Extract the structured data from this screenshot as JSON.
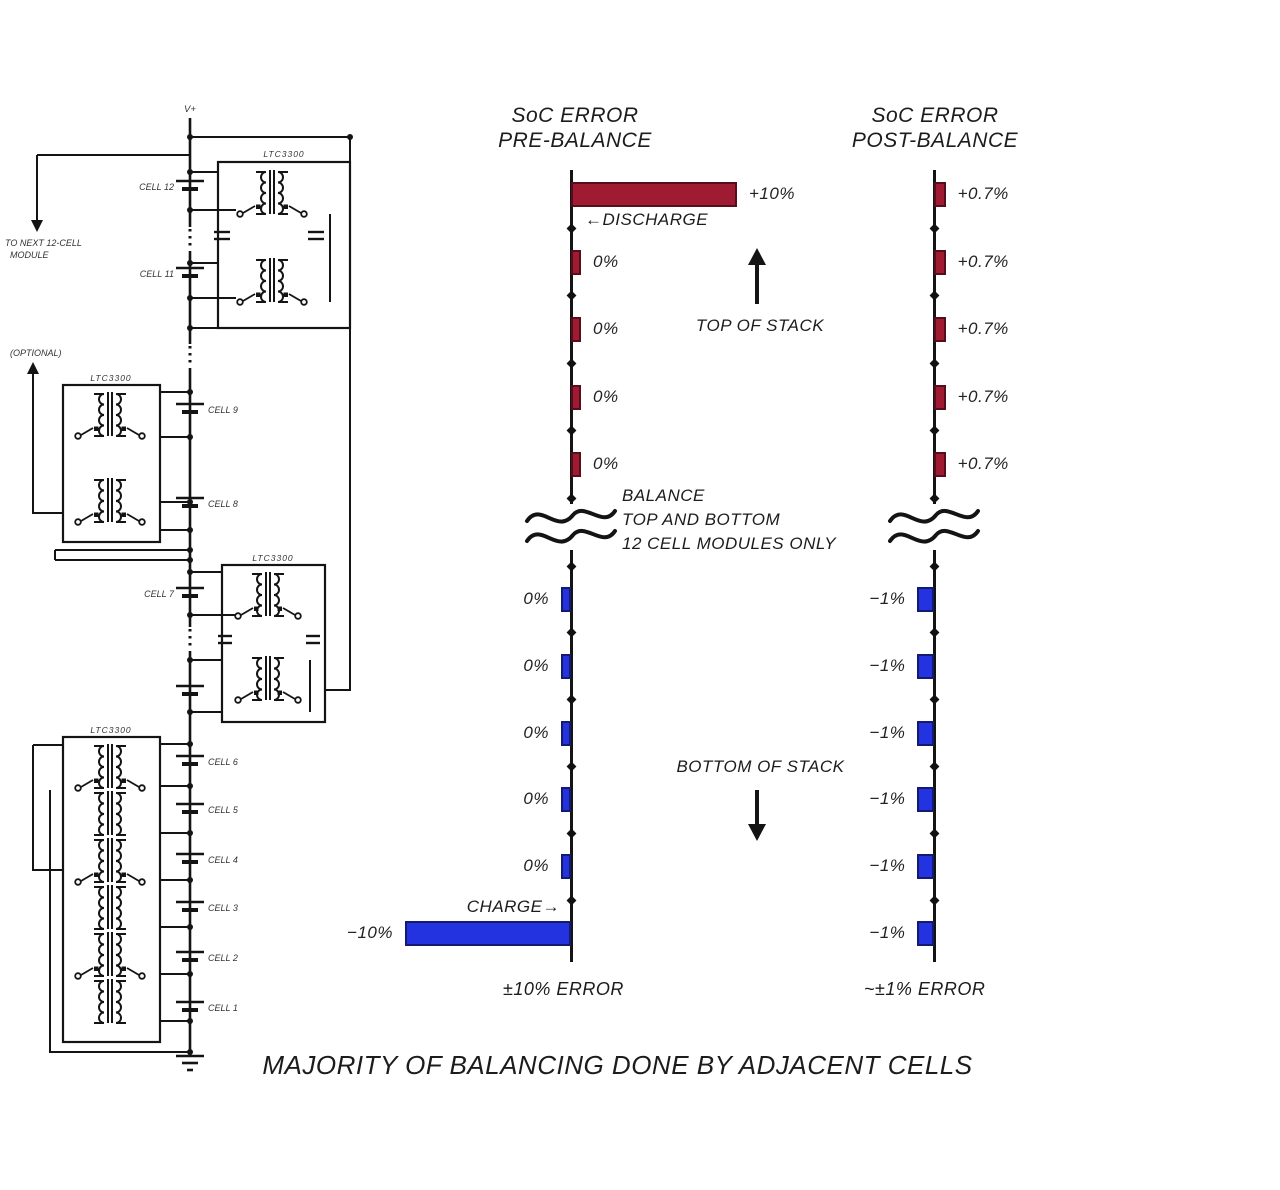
{
  "page": {
    "footer_title": "MAJORITY OF BALANCING DONE BY ADJACENT CELLS"
  },
  "colors": {
    "discharge_red": "#9e1b32",
    "discharge_red_border": "#560d1c",
    "charge_blue": "#2433e0",
    "charge_blue_border": "#141a6e",
    "line_black": "#141414"
  },
  "schematic": {
    "stack_top_label": "V+",
    "ground": "GND",
    "cells": [
      "CELL 12",
      "CELL 11",
      "CELL 9",
      "CELL 8",
      "CELL 7",
      "CELL 6",
      "CELL 5",
      "CELL 4",
      "CELL 3",
      "CELL 2",
      "CELL 1"
    ],
    "modules": [
      {
        "chip": "LTC3300"
      },
      {
        "chip": "LTC3300"
      },
      {
        "chip": "LTC3300"
      },
      {
        "chip": "LTC3300"
      }
    ],
    "annotation_top": {
      "line1": "TO NEXT 12-CELL",
      "line2": "MODULE"
    },
    "annotation_mid": "(OPTIONAL)"
  },
  "annotations": {
    "top_of_stack": "TOP OF STACK",
    "bottom_of_stack": "BOTTOM OF STACK",
    "balance_line1": "BALANCE",
    "balance_line2": "TOP AND BOTTOM",
    "balance_line3": "12 CELL MODULES ONLY"
  },
  "chart_data": [
    {
      "type": "bar",
      "orientation": "horizontal",
      "title1": "SoC ERROR",
      "title2": "PRE-BALANCE",
      "axis": "battery stack position (top to bottom)",
      "units": "% state-of-charge error",
      "top_bars": {
        "color_key": "discharge_red",
        "values": [
          10,
          0,
          0,
          0,
          0
        ],
        "labels": [
          "+10%",
          "0%",
          "0%",
          "0%",
          "0%"
        ]
      },
      "bottom_bars": {
        "color_key": "charge_blue",
        "values": [
          0,
          0,
          0,
          0,
          0,
          -10
        ],
        "labels": [
          "0%",
          "0%",
          "0%",
          "0%",
          "0%",
          "−10%"
        ]
      },
      "discharge_label": "←DISCHARGE",
      "charge_label": "CHARGE→",
      "footer": "±10% ERROR"
    },
    {
      "type": "bar",
      "orientation": "horizontal",
      "title1": "SoC ERROR",
      "title2": "POST-BALANCE",
      "axis": "battery stack position (top to bottom)",
      "units": "% state-of-charge error",
      "top_bars": {
        "color_key": "discharge_red",
        "values": [
          0.7,
          0.7,
          0.7,
          0.7,
          0.7
        ],
        "labels": [
          "+0.7%",
          "+0.7%",
          "+0.7%",
          "+0.7%",
          "+0.7%"
        ]
      },
      "bottom_bars": {
        "color_key": "charge_blue",
        "values": [
          -1,
          -1,
          -1,
          -1,
          -1,
          -1
        ],
        "labels": [
          "−1%",
          "−1%",
          "−1%",
          "−1%",
          "−1%",
          "−1%"
        ]
      },
      "footer": "~±1% ERROR"
    }
  ]
}
